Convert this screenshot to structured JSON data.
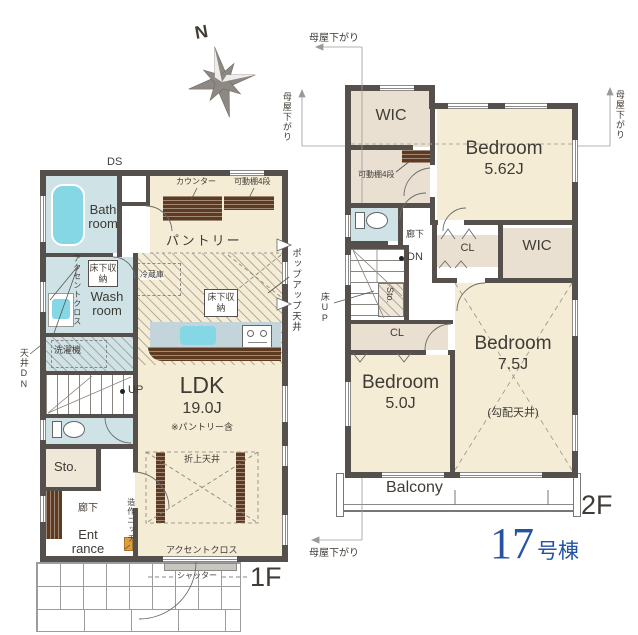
{
  "building": {
    "number": "17",
    "suffix": "号棟"
  },
  "compass": {
    "north": "N"
  },
  "floor1": {
    "label": "1F",
    "rooms": {
      "bath": "Bath room",
      "wash": "Wash room",
      "pantry": "パントリー",
      "ldk": "LDK",
      "ldk_size": "19.0J",
      "ldk_note": "※パントリー含",
      "storage": "Sto.",
      "hallway": "廊下",
      "entrance": "Ent rance"
    },
    "labels": {
      "ds": "DS",
      "counter": "カウンター",
      "movable_shelf": "可動棚4段",
      "underfloor_storage_wash": "床下収納",
      "underfloor_storage_kitchen": "床下収納",
      "accent_cloth_wash": "アクセントクロス",
      "accent_cloth_ldk": "アクセントクロス",
      "washing_machine": "洗濯機",
      "fridge": "冷蔵庫",
      "ceiling_down": "天井DN",
      "up": "UP",
      "popup_ceiling": "ポップアップ天井",
      "coffered_ceiling": "折上天井",
      "built_in_niche": "造作ニッチ",
      "shutter": "シャッター"
    }
  },
  "floor2": {
    "label": "2F",
    "rooms": {
      "wic_top": "WIC",
      "wic_side": "WIC",
      "bedroom_a": "Bedroom",
      "bedroom_a_size": "5.62J",
      "bedroom_b": "Bedroom",
      "bedroom_b_size": "5.0J",
      "bedroom_c": "Bedroom",
      "bedroom_c_size": "7.5J",
      "bedroom_c_note": "(勾配天井)",
      "closet_a": "CL",
      "closet_b": "CL",
      "hallway": "廊下",
      "storage": "Sto.",
      "balcony": "Balcony"
    },
    "labels": {
      "movable_shelf": "可動棚4段",
      "dn": "DN",
      "floor_up": "床UP",
      "moya_top": "母屋下がり",
      "moya_left": "母屋下がり",
      "moya_right": "母屋下がり",
      "moya_bottom": "母屋下がり"
    }
  }
}
